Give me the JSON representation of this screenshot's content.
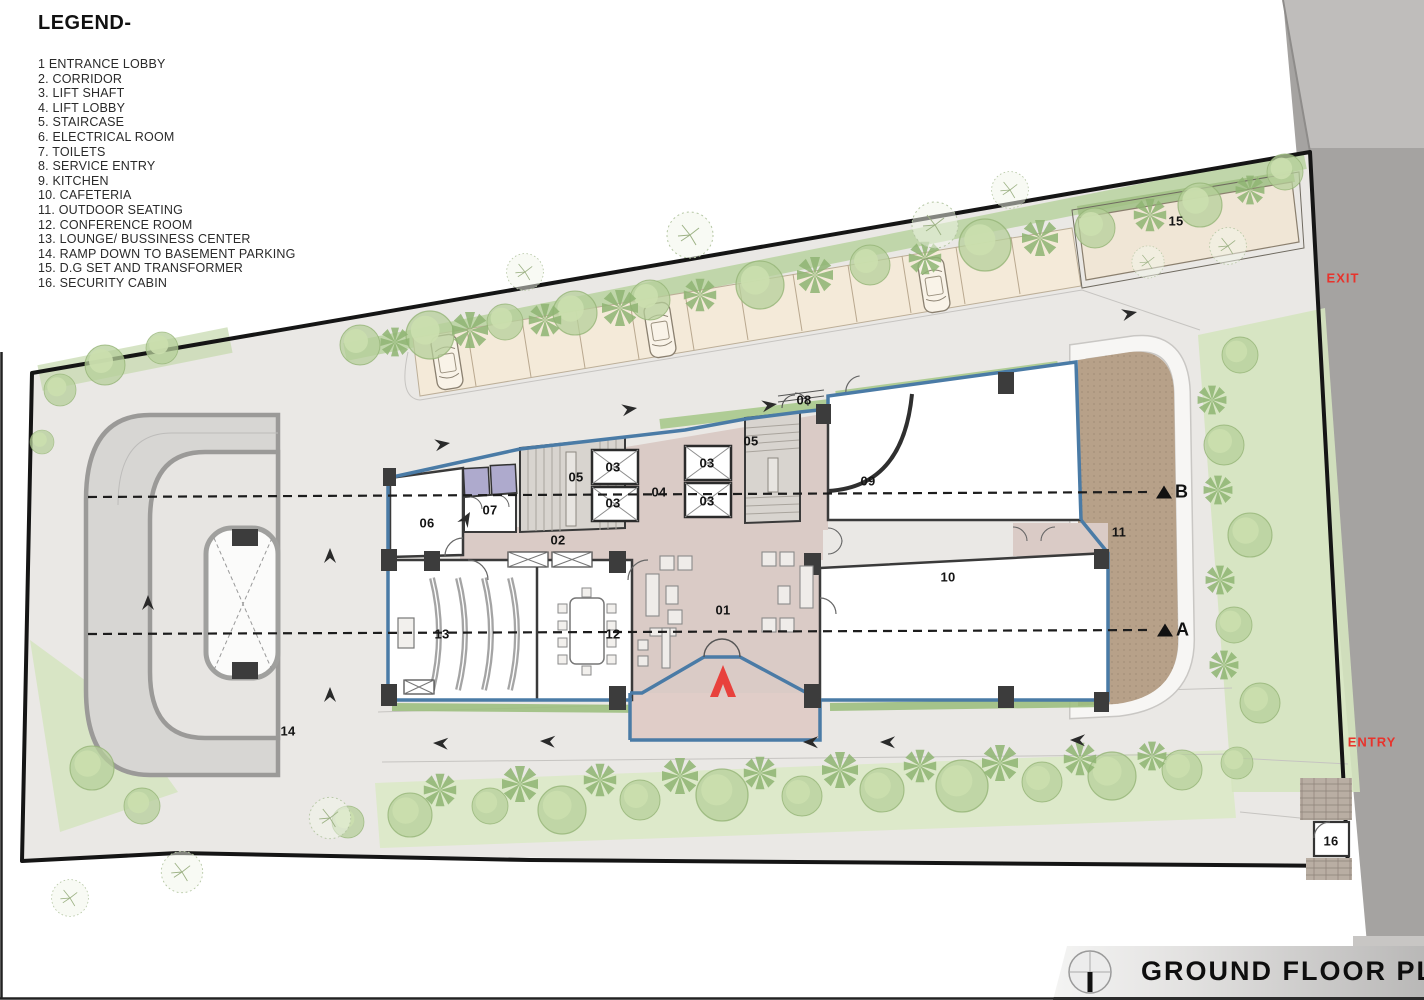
{
  "legend": {
    "title": "LEGEND-",
    "items": [
      "1  ENTRANCE LOBBY",
      "2. CORRIDOR",
      "3. LIFT SHAFT",
      "4. LIFT LOBBY",
      "5. STAIRCASE",
      "6. ELECTRICAL ROOM",
      "7. TOILETS",
      "8. SERVICE ENTRY",
      "9. KITCHEN",
      "10. CAFETERIA",
      "11. OUTDOOR SEATING",
      "12. CONFERENCE ROOM",
      "13. LOUNGE/ BUSSINESS CENTER",
      "14. RAMP DOWN TO BASEMENT PARKING",
      "15. D.G SET AND TRANSFORMER",
      "16. SECURITY CABIN"
    ]
  },
  "title_block": {
    "title": "GROUND FLOOR PLAN"
  },
  "plan": {
    "room_labels": [
      {
        "num": "01",
        "x": 723,
        "y": 610
      },
      {
        "num": "02",
        "x": 558,
        "y": 540
      },
      {
        "num": "03",
        "x": 613,
        "y": 467
      },
      {
        "num": "03",
        "x": 613,
        "y": 503
      },
      {
        "num": "03",
        "x": 707,
        "y": 463
      },
      {
        "num": "03",
        "x": 707,
        "y": 501
      },
      {
        "num": "04",
        "x": 659,
        "y": 492
      },
      {
        "num": "05",
        "x": 576,
        "y": 477
      },
      {
        "num": "05",
        "x": 751,
        "y": 441
      },
      {
        "num": "06",
        "x": 427,
        "y": 523
      },
      {
        "num": "07",
        "x": 490,
        "y": 510
      },
      {
        "num": "08",
        "x": 804,
        "y": 400
      },
      {
        "num": "09",
        "x": 868,
        "y": 481
      },
      {
        "num": "10",
        "x": 948,
        "y": 577
      },
      {
        "num": "11",
        "x": 1119,
        "y": 532
      },
      {
        "num": "12",
        "x": 613,
        "y": 634
      },
      {
        "num": "13",
        "x": 442,
        "y": 634
      },
      {
        "num": "14",
        "x": 288,
        "y": 731
      },
      {
        "num": "15",
        "x": 1176,
        "y": 221
      },
      {
        "num": "16",
        "x": 1331,
        "y": 841
      }
    ],
    "section_markers": [
      {
        "letter": "B",
        "x": 1156,
        "y": 492
      },
      {
        "letter": "A",
        "x": 1157,
        "y": 630
      }
    ],
    "gate_labels": [
      {
        "text": "EXIT",
        "x": 1343,
        "y": 278
      },
      {
        "text": "ENTRY",
        "x": 1372,
        "y": 742
      }
    ]
  },
  "colors": {
    "accent_red": "#e8332c",
    "exterior_wall_blue": "#4a7ba6",
    "floor_pink": "#dacbc6",
    "toilet_purple": "#aeaacd",
    "outdoor_brown": "#b7a189",
    "road_gray": "#a5a3a1",
    "landscape_green": "#d9e6c8"
  }
}
